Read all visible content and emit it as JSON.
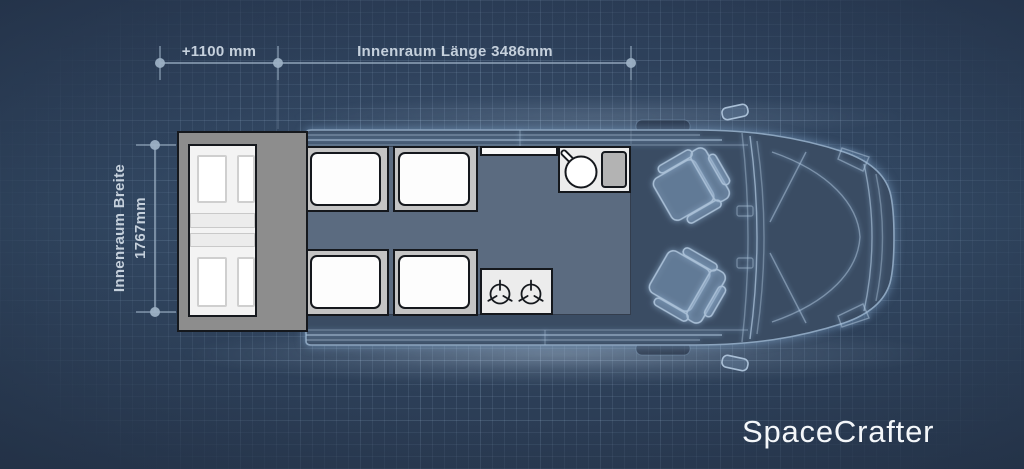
{
  "brand": {
    "logo_text": "SpaceCrafter"
  },
  "dimensions": {
    "extension_label": "+1100 mm",
    "length_label": "Innenraum Länge 3486mm",
    "width_label_line1": "Innenraum Breite",
    "width_label_line2": "1767mm"
  },
  "floorplan": {
    "view": "top-down camper van blueprint floor plan",
    "zones": {
      "rear_extension_bed": {
        "cushions": 4,
        "fold_strips": 2
      },
      "bench_modules": {
        "count": 4,
        "cushion_per_module": 1
      },
      "kitchen": {
        "sink": "round sink with faucet and drainboard",
        "stove_burners": 2
      },
      "cab": {
        "swivel_seats": 2
      }
    },
    "colors": {
      "background": "#2d415c",
      "floor": "#5b6b80",
      "bench_base": "#c4c4c4",
      "cushion_white": "#fdfdfd",
      "extension_box_gray": "#8d8d8d",
      "kitchen_unit": "#ececec",
      "blueprint_line": "#a8c0d8",
      "dimension_line": "#9cb0c4",
      "label_text": "#c5d0dc",
      "logo_text": "#f4f7fa"
    }
  }
}
